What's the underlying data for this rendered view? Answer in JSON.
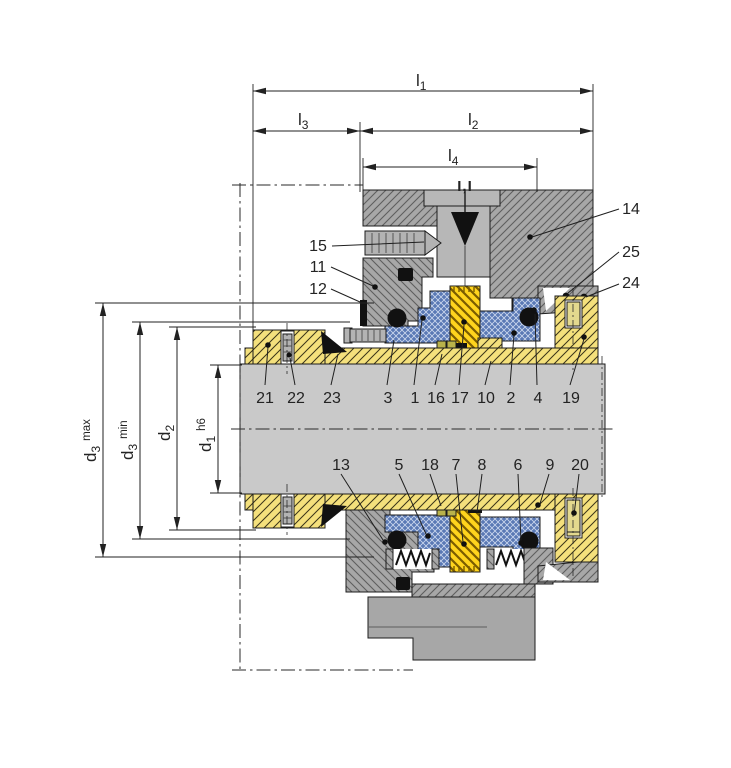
{
  "drawing": {
    "port_mark": "I,I"
  },
  "dims": {
    "l1": {
      "base": "l",
      "sub": "1"
    },
    "l2": {
      "base": "l",
      "sub": "2"
    },
    "l3": {
      "base": "l",
      "sub": "3"
    },
    "l4": {
      "base": "l",
      "sub": "4"
    },
    "d1": {
      "base": "d",
      "sub": "1",
      "qual": "h6"
    },
    "d2": {
      "base": "d",
      "sub": "2",
      "qual": ""
    },
    "d3min": {
      "base": "d",
      "sub": "3",
      "qual": "min"
    },
    "d3max": {
      "base": "d",
      "sub": "3",
      "qual": "max"
    }
  },
  "parts": {
    "p1": "1",
    "p2": "2",
    "p3": "3",
    "p4": "4",
    "p5": "5",
    "p6": "6",
    "p7": "7",
    "p8": "8",
    "p9": "9",
    "p10": "10",
    "p11": "11",
    "p12": "12",
    "p13": "13",
    "p14": "14",
    "p15": "15",
    "p16": "16",
    "p17": "17",
    "p18": "18",
    "p19": "19",
    "p20": "20",
    "p21": "21",
    "p22": "22",
    "p23": "23",
    "p24": "24",
    "p25": "25"
  },
  "colors": {
    "housing": "#a7a7a7",
    "shaft": "#c9c9c9",
    "sleeve": "#f4e07c",
    "face": "#ffd41d",
    "seal": "#5a79b5",
    "steel": "#b3b3b3",
    "port": "#b7b7b7",
    "outline": "#1c1c1c",
    "ink": "#111111"
  }
}
